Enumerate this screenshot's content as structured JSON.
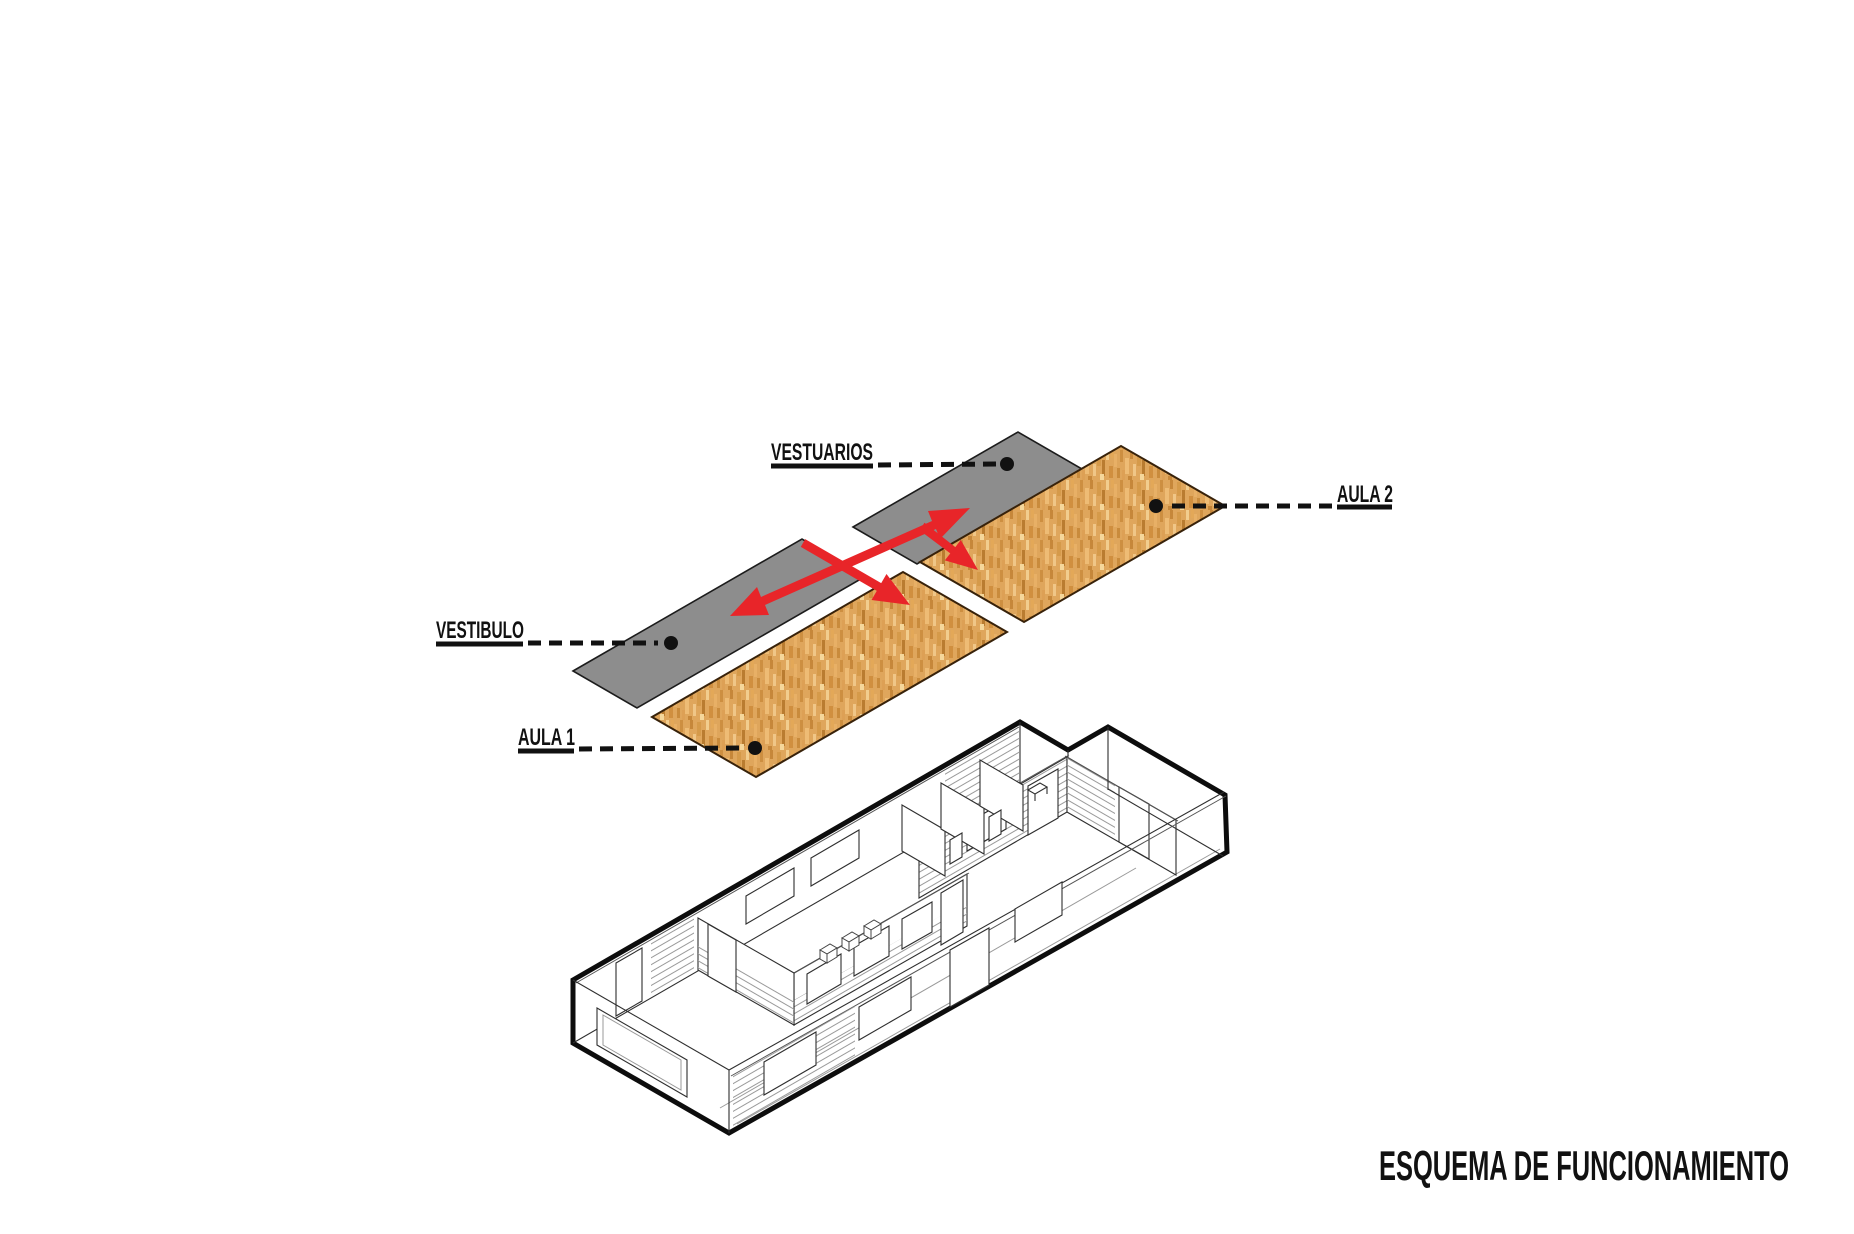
{
  "diagram": {
    "labels": {
      "vestuarios": "VESTUARIOS",
      "vestibulo": "VESTIBULO",
      "aula1": "AULA 1",
      "aula2": "AULA 2"
    }
  },
  "caption": {
    "title": "ESQUEMA DE FUNCIONAMIENTO"
  },
  "colors": {
    "gray": "#8d8d8d",
    "wood": "#dfa65c",
    "red": "#e82529",
    "ink": "#111111"
  }
}
